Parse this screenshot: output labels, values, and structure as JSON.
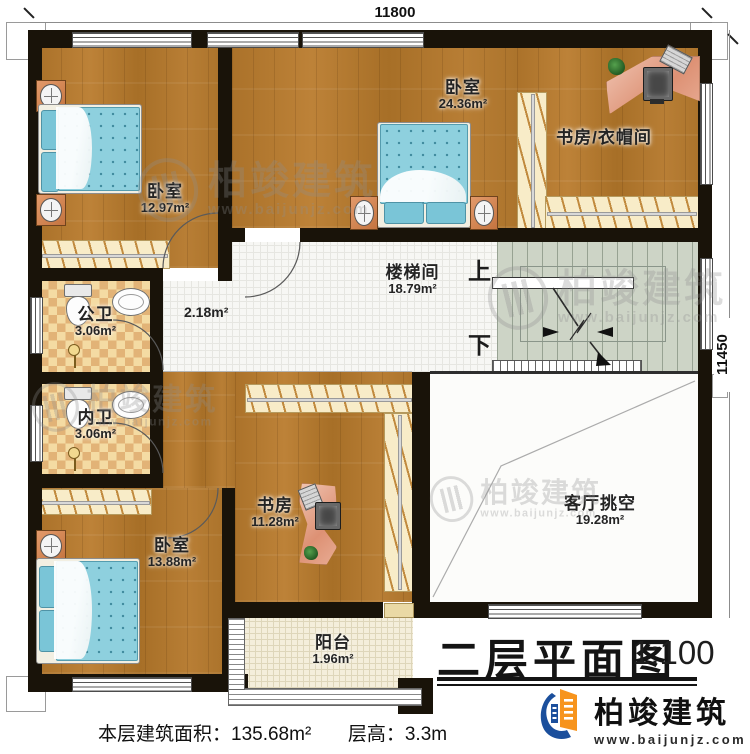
{
  "plan_title": {
    "text": "二层平面图",
    "scale": "1:100"
  },
  "dimensions": {
    "top": "11800",
    "right": "11450"
  },
  "rooms": {
    "bedroom_tl": {
      "name": "卧室",
      "area": "12.97m²"
    },
    "bedroom_top": {
      "name": "卧室",
      "area": "24.36m²"
    },
    "study_cloak": {
      "name": "书房/衣帽间"
    },
    "stair_hall": {
      "name": "楼梯间",
      "area": "18.79m²"
    },
    "hallway": {
      "area": "2.18m²"
    },
    "bath_public": {
      "name": "公卫",
      "area": "3.06m²"
    },
    "bath_private": {
      "name": "内卫",
      "area": "3.06m²"
    },
    "study": {
      "name": "书房",
      "area": "11.28m²"
    },
    "bedroom_bl": {
      "name": "卧室",
      "area": "13.88m²"
    },
    "living_void": {
      "name": "客厅挑空",
      "area": "19.28m²"
    },
    "balcony": {
      "name": "阳台",
      "area": "1.96m²"
    }
  },
  "stairs": {
    "up": "上",
    "down": "下"
  },
  "footer": {
    "area_text": "本层建筑面积：135.68m²",
    "height_text": "层高：3.3m"
  },
  "brand": {
    "name": "柏竣建筑",
    "url": "www.baijunjz.com"
  },
  "watermark": {
    "name": "柏竣建筑",
    "url": "www.baijunjz.com"
  },
  "colors": {
    "wall": "#191309",
    "wood": "#b27a31",
    "tile": "#f7f7f4",
    "checker": "#e2b377",
    "stairs": "#cdd4c6",
    "bed": "#8ed0de",
    "desk": "#e8a28b",
    "brand_blue": "#1b4f9c",
    "brand_orange": "#f7941d"
  }
}
